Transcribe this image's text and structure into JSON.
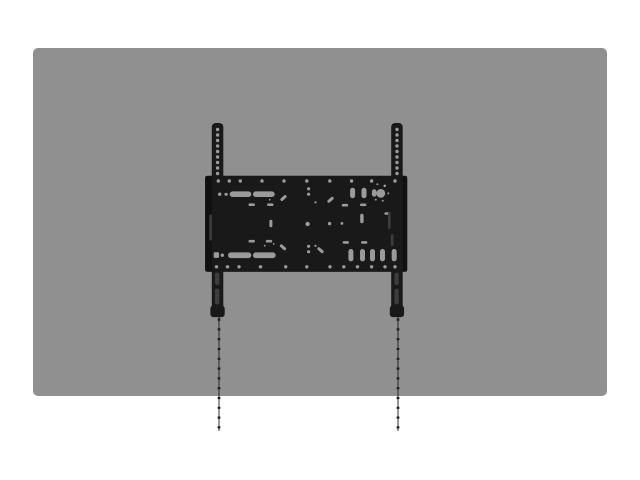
{
  "scene": {
    "type": "product-illustration",
    "subject": "fixed flat-panel TV wall mount bracket shown on display back panel",
    "elements": {
      "display_panel": "display-panel",
      "wall_plate": "wall-plate",
      "left_rail": "left-vesa-rail",
      "right_rail": "right-vesa-rail",
      "bubble_level": "bubble-level",
      "plumb_line_left": "left-plumb-line",
      "plumb_line_right": "right-plumb-line"
    }
  },
  "colors": {
    "background": "#ffffff",
    "panel": "#909090",
    "bracket": "#191919",
    "bracket_dark": "#111111",
    "hole": "#9b9b9b",
    "slot": "#9b9b9b",
    "rail_slot": "#3d3d3d",
    "line": "#1c1c1c"
  }
}
